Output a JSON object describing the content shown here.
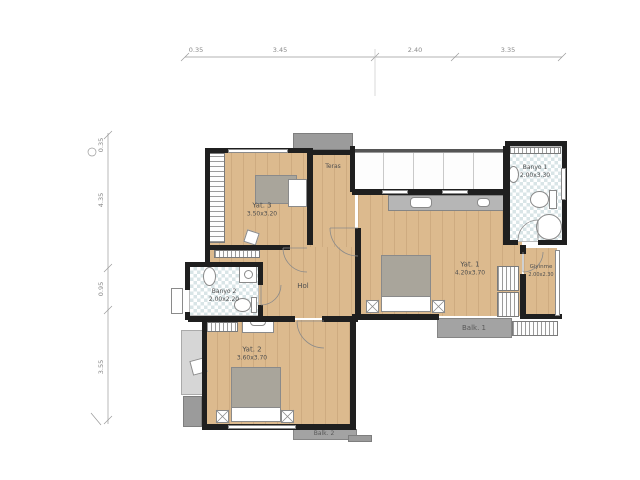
{
  "rooms": {
    "yat3": {
      "name": "Yat. 3",
      "dims": "3.50x3.20"
    },
    "teras": {
      "name": "Teras"
    },
    "yat1": {
      "name": "Yat. 1",
      "dims": "4.20x3.70"
    },
    "banyo1": {
      "name": "Banyo 1",
      "dims": "2.00x3.30"
    },
    "giyinme": {
      "name": "Giyinme",
      "dims": "2.00x2.30"
    },
    "banyo2": {
      "name": "Banyo 2",
      "dims": "2.00x2.20"
    },
    "hol": {
      "name": "Hol"
    },
    "yat2": {
      "name": "Yat. 2",
      "dims": "3.60x3.70"
    },
    "balk1": {
      "name": "Balk. 1"
    },
    "balk2": {
      "name": "Balk. 2"
    }
  },
  "dimensions": {
    "top": [
      "0.35",
      "3.45",
      "2.40",
      "3.35"
    ],
    "left": [
      "0.35",
      "4.35",
      "0.95",
      "3.55"
    ]
  },
  "colors": {
    "wood": "#dcba8e",
    "wall": "#1f1f1f",
    "tile": "#d9e5e7",
    "balcony": "#a3a3a3",
    "furniture_gray": "#a9a59b"
  }
}
